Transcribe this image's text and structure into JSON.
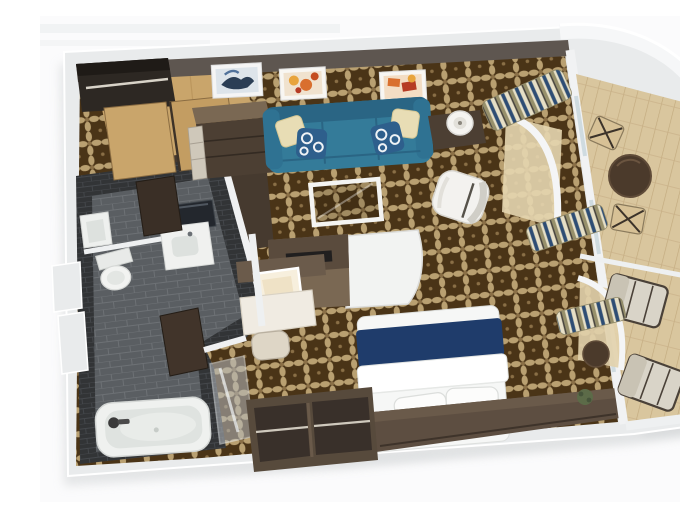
{
  "scene": {
    "title": "Stateroom 3D floor plan",
    "description": "Isometric 3D rendering of a cruise-ship balcony stateroom floor plan with living area, bedroom, bathroom, entry wardrobe and private balcony",
    "rooms": [
      {
        "id": "living-area",
        "label": "Living area"
      },
      {
        "id": "bedroom",
        "label": "Bedroom"
      },
      {
        "id": "bathroom",
        "label": "Bathroom"
      },
      {
        "id": "entry-wardrobe",
        "label": "Entry and wardrobe"
      },
      {
        "id": "balcony",
        "label": "Private balcony"
      }
    ],
    "furniture": [
      {
        "id": "sofa",
        "label": "Teal sofa with throw pillows"
      },
      {
        "id": "wall-art",
        "label": "Three framed artworks above sofa"
      },
      {
        "id": "side-table-lamp",
        "label": "Side table with lamp"
      },
      {
        "id": "coffee-table",
        "label": "Glass coffee table"
      },
      {
        "id": "armchair",
        "label": "White armchair"
      },
      {
        "id": "media-console",
        "label": "Curved media console partition"
      },
      {
        "id": "vanity-desk",
        "label": "Vanity desk with lit mirror and stool"
      },
      {
        "id": "bed",
        "label": "Double bed with navy runner"
      },
      {
        "id": "headboard-dresser",
        "label": "Headboard and dresser unit"
      },
      {
        "id": "wardrobe",
        "label": "Open wardrobe bays with hanging rods"
      },
      {
        "id": "closet",
        "label": "Entry closet with rod and sliding wood doors"
      },
      {
        "id": "drawer-cabinet",
        "label": "Drawer cabinet"
      },
      {
        "id": "bathtub",
        "label": "Bathtub"
      },
      {
        "id": "shower",
        "label": "Glass shower panel"
      },
      {
        "id": "toilet",
        "label": "Toilet"
      },
      {
        "id": "washbasins",
        "label": "Two washbasins with mirror"
      },
      {
        "id": "curtains",
        "label": "Striped drapes along window wall"
      },
      {
        "id": "balcony-dining",
        "label": "Round balcony table with two chairs"
      },
      {
        "id": "lounge-chairs",
        "label": "Two balcony lounge chairs"
      },
      {
        "id": "balcony-side-table",
        "label": "Small balcony side table"
      },
      {
        "id": "plant",
        "label": "Potted plant"
      }
    ],
    "palette": {
      "background": "#fbfbfc",
      "wall": "#e9ebec",
      "wallEdge": "#ffffff",
      "topBand": "#5e5650",
      "carpetBase": "#4a3417",
      "carpetMotif": "#b9a071",
      "woodLight": "#c9a56b",
      "woodMid": "#7a6853",
      "woodDark": "#4c3f33",
      "tileWall": "#323436",
      "tileFloor": "#5a5e62",
      "grout": "#6d7175",
      "sofa": "#347b99",
      "sofaDark": "#2a6584",
      "cushionCream": "#e8ddb5",
      "pillowNavy": "#2e5f8c",
      "bedRunner": "#1f3c6b",
      "linenWhite": "#f6f7f6",
      "balconyFloor": "#d9c69e",
      "balconyWood": "#4b3a2b",
      "curtainNavy": "#2e4d74",
      "curtainOlive": "#97906b",
      "curtainCream": "#e6dfc6",
      "glass": "#cfdbe0",
      "plant": "#5c6b48"
    }
  }
}
